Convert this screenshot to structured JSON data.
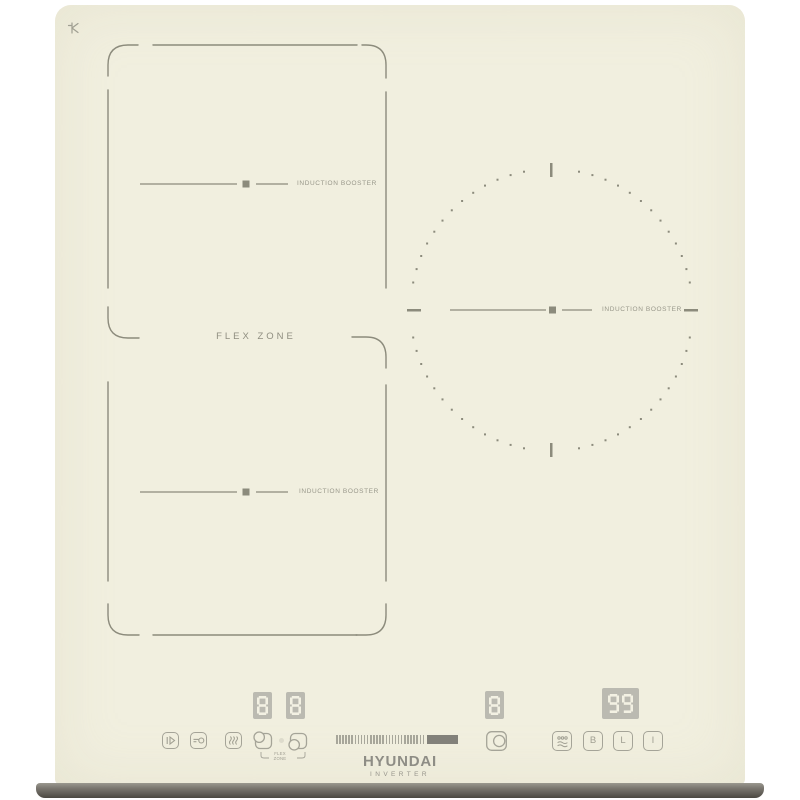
{
  "brand": {
    "name": "HYUNDAI",
    "subtitle": "INVERTER"
  },
  "zones": {
    "flex_label": "FLEX ZONE",
    "top_left": {
      "label": "INDUCTION BOOSTER"
    },
    "bottom_left": {
      "label": "INDUCTION BOOSTER"
    },
    "right": {
      "label": "INDUCTION BOOSTER"
    }
  },
  "displays": {
    "flex_upper": "8",
    "flex_lower": "8",
    "right_zone": "8",
    "timer": "99"
  },
  "controls": {
    "flex_selector_caption": "FLEX ZONE",
    "booster_label": "B",
    "lock_label": "L",
    "power_label": "I",
    "slider_ticks": 29,
    "icon_names": [
      "pause-icon",
      "key-lock-icon",
      "keep-warm-icon",
      "flex-zone-upper-icon",
      "flex-zone-lower-icon",
      "zone-select-icon",
      "simmer-icon",
      "booster-button",
      "lock-button",
      "power-button"
    ]
  },
  "colors": {
    "surface": "#f1efdf",
    "marking": "#8c8b7c",
    "label_text": "#98978a",
    "display_bg": "#bbbab1",
    "display_segment": "#f3f1e3",
    "slider_fill": "#82817a",
    "front_strip": "#57544e"
  }
}
